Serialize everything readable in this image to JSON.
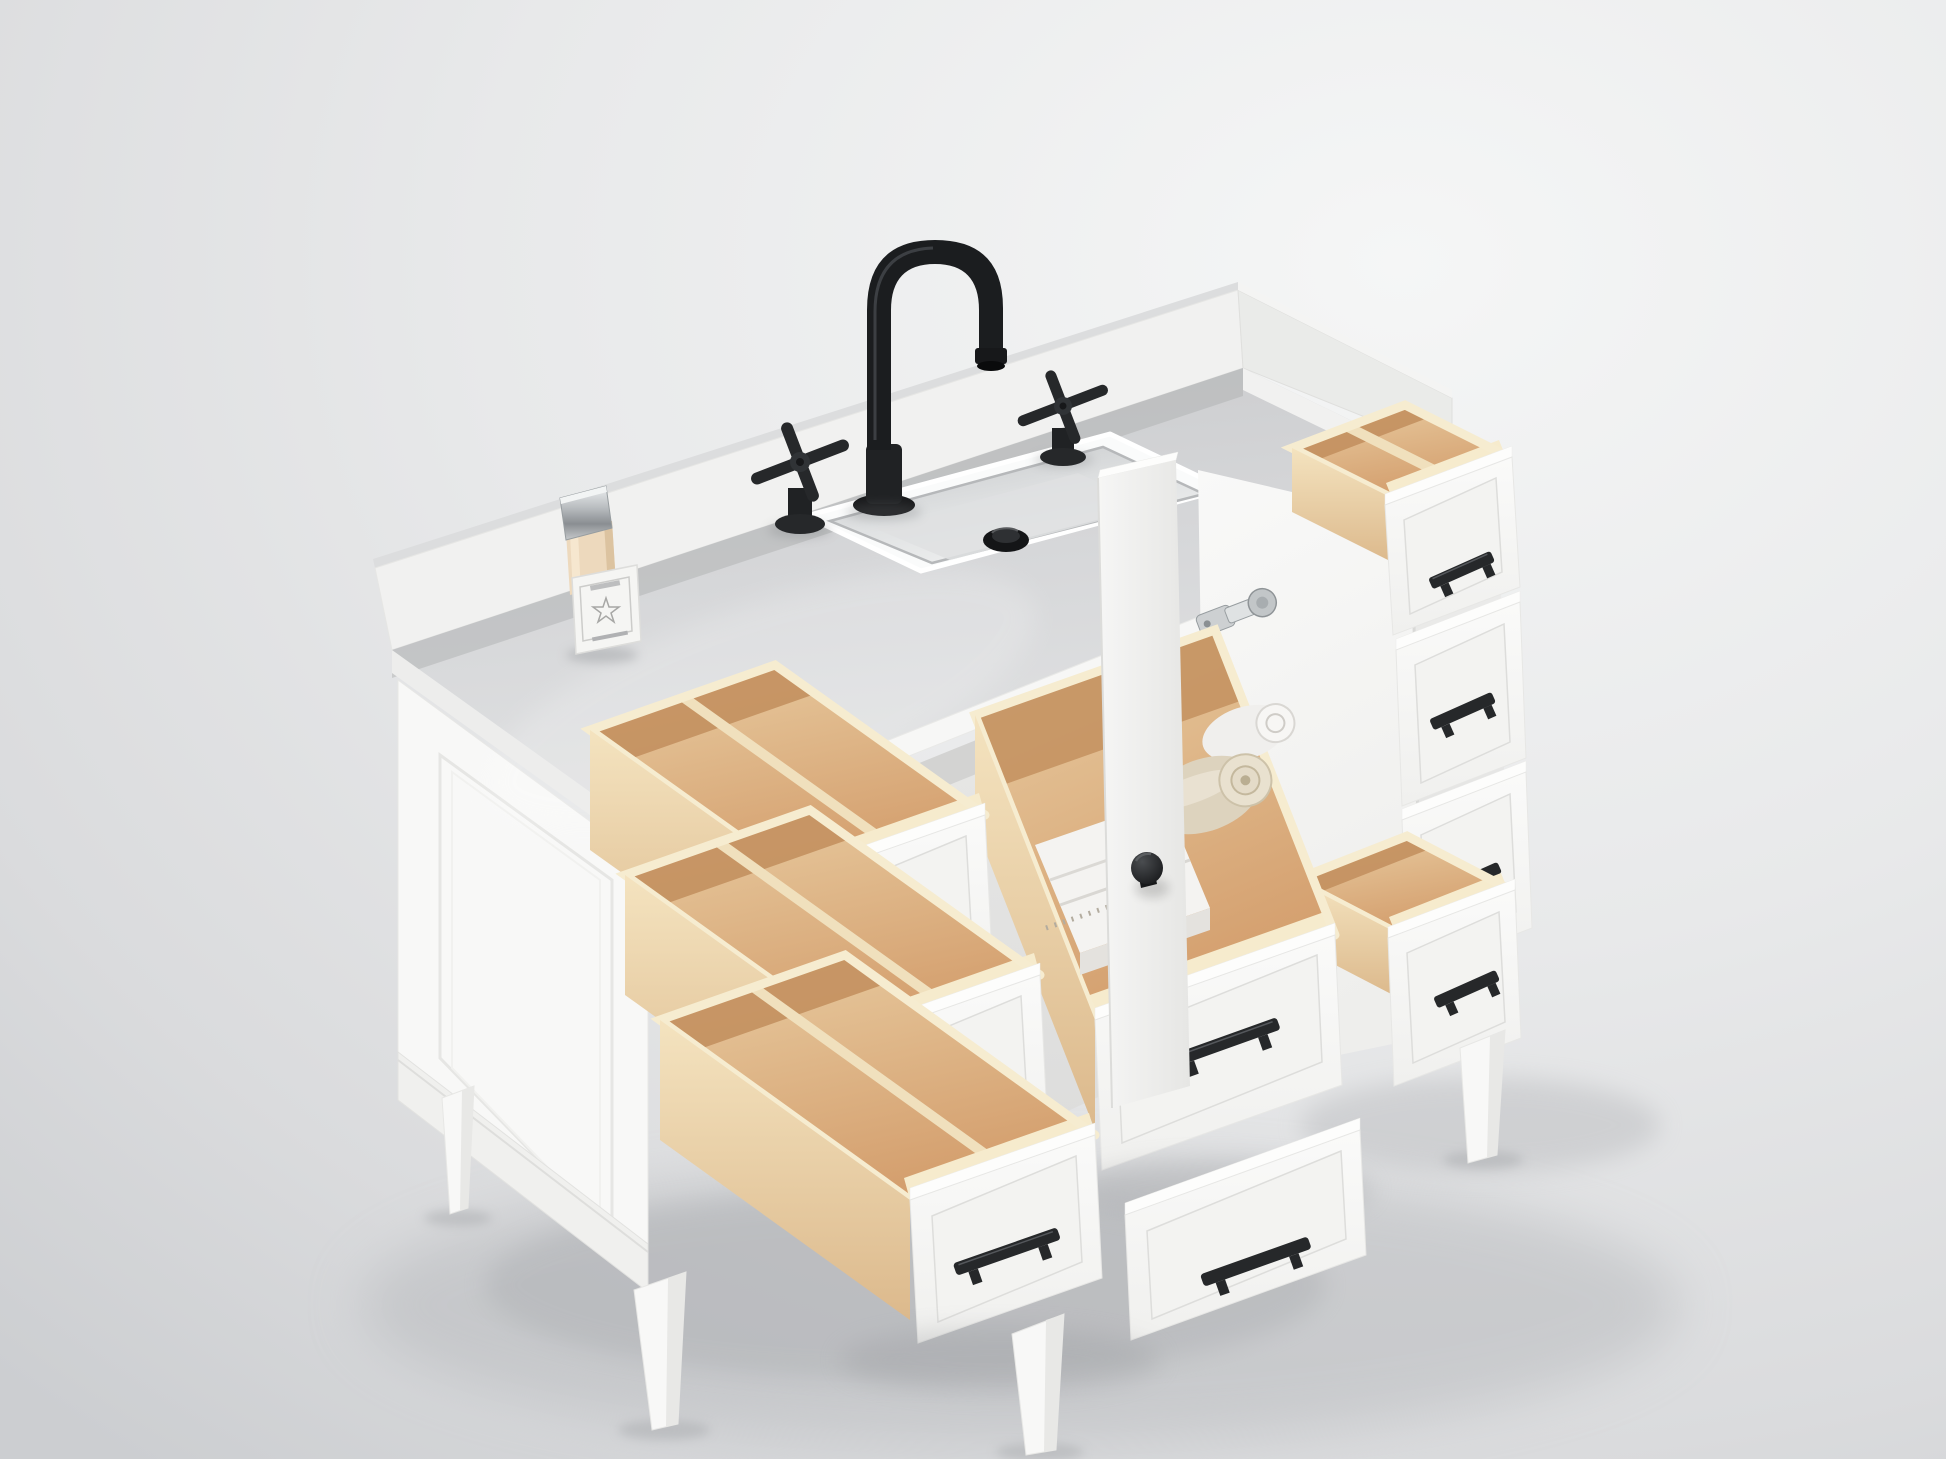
{
  "scene": {
    "description": "Studio render of a white bathroom vanity viewed from above at three-quarter angle, with drawers and door open to show natural wood interiors",
    "background": {
      "base": "#e7e8ea",
      "highlight": "#f5f6f6",
      "edge_shade": "#ccced1",
      "floor_shadow": "#b6b8bb"
    }
  },
  "palette": {
    "cabinet_white": "#f8f8f7",
    "countertop_gray": "#d4d5d7",
    "counter_edge_white": "#f7f7f6",
    "backsplash_white": "#f1f1f0",
    "wood_light": "#f4e3bf",
    "wood_medium": "#e3c393",
    "wood_shadow": "#c3905f",
    "hardware_black": "#26282a",
    "faucet_black": "#1b1d1f",
    "chrome": "#c7cacc",
    "ceramic_white": "#fafbfb",
    "towel_white": "#f1f0ee",
    "towel_beige": "#ddd3be",
    "bottle_cream": "#edd9bd"
  },
  "vanity": {
    "label": "white bathroom vanity cabinet",
    "countertop": {
      "label": "white quartz countertop",
      "color": "#d4d5d7"
    },
    "backsplash": {
      "label": "countertop backsplash"
    },
    "sink": {
      "label": "rectangular undermount ceramic sink",
      "drain": "black pop-up drain"
    },
    "faucet": {
      "label": "matte black gooseneck faucet",
      "handle_count": 2,
      "handle_style": "cross handles",
      "finish": "#1b1d1f"
    },
    "soap_bottle": {
      "label": "soap bottle with chrome cap",
      "cap": "#c7cacc",
      "liquid": "#edd9bd",
      "label_motif": "star"
    },
    "left_drawers": {
      "label": "left drawer stack",
      "count": 3,
      "state": "open",
      "interior": "natural wood with center divider"
    },
    "door": {
      "label": "center cabinet door",
      "state": "open",
      "knob": "black round knob",
      "hinge_count": 2,
      "hinge_finish": "chrome"
    },
    "towel_drawer": {
      "label": "center storage drawer",
      "state": "open",
      "contents": [
        "folded towels",
        "beige rolled towel",
        "white rolled towel"
      ]
    },
    "bottom_drawer": {
      "label": "bottom center drawer",
      "state": "closed"
    },
    "right_drawers": {
      "label": "right drawer bank",
      "count": 4,
      "open_positions": [
        "top",
        "bottom"
      ]
    },
    "hardware": {
      "label": "matte black bar pulls",
      "finish": "#26282a"
    },
    "legs": {
      "label": "tapered wood legs",
      "count": 4,
      "finish": "white"
    }
  }
}
